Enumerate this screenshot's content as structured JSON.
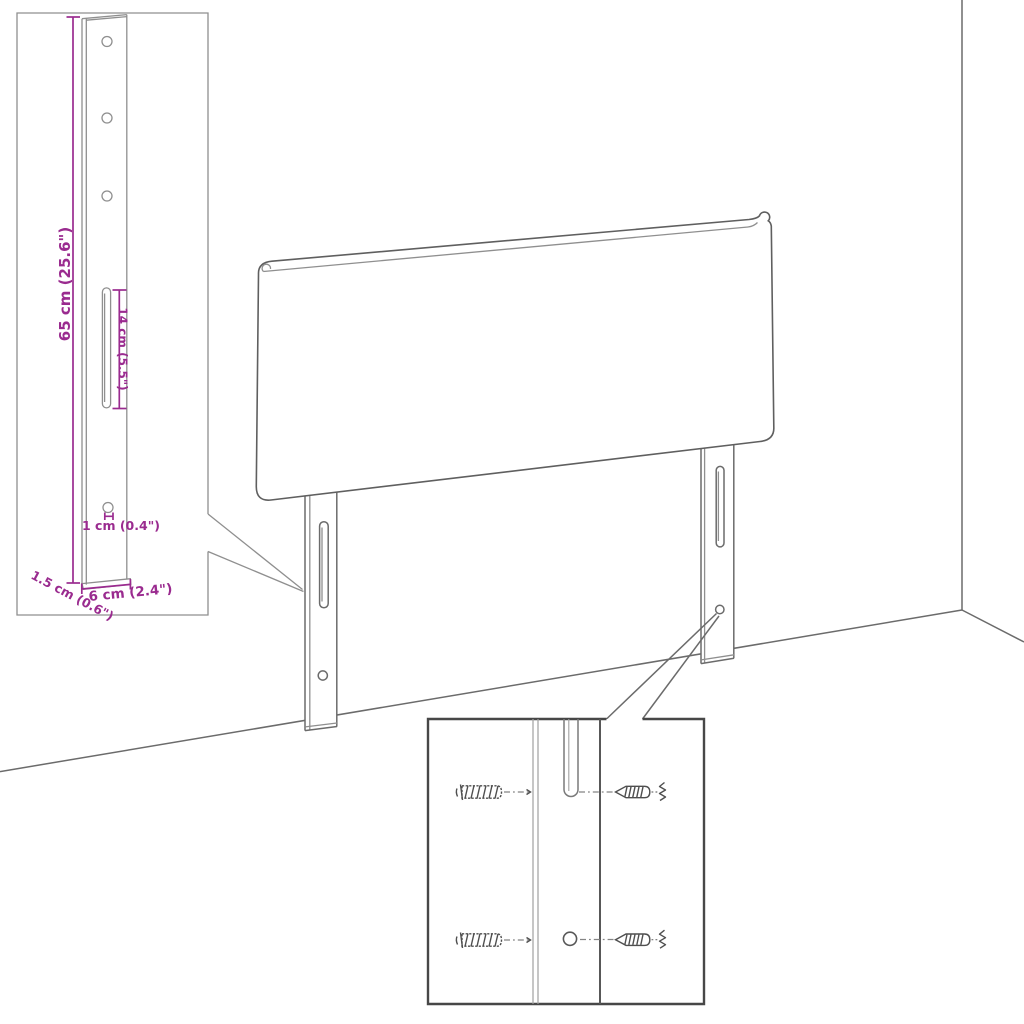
{
  "colors": {
    "accent": "#9a2b8f",
    "outline": "#6b6b6b",
    "inset_border_light": "#8f8f8f",
    "inset_border_dark": "#474747",
    "background": "#ffffff"
  },
  "leg_dimension_inset": {
    "labels": {
      "height": "65 cm (25.6\")",
      "slot_length": "14 cm (5.5\")",
      "hole": "1 cm (0.4\")",
      "depth": "1.5 cm (0.6\")",
      "width": "6 cm (2.4\")"
    }
  },
  "hardware_inset": {
    "parts": [
      "wall plug",
      "screw"
    ]
  }
}
